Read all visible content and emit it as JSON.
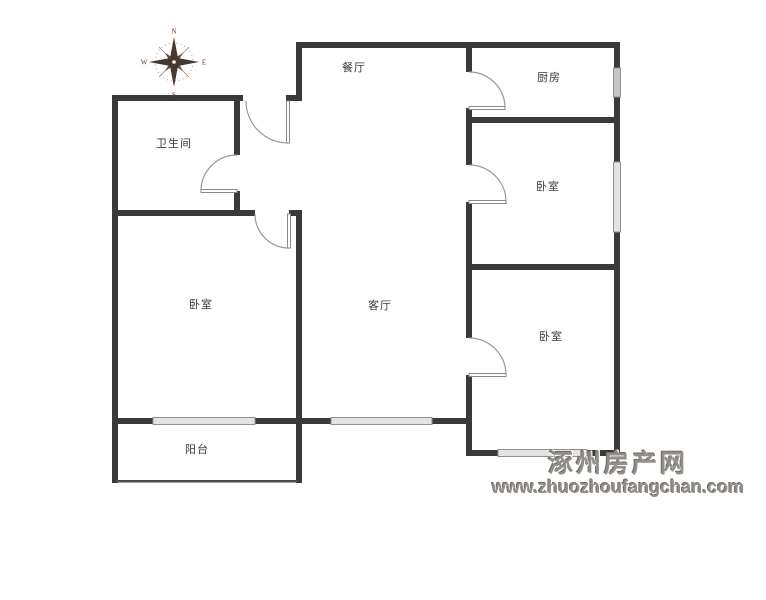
{
  "plan": {
    "rooms": [
      {
        "id": "dining",
        "label": "餐厅"
      },
      {
        "id": "kitchen",
        "label": "厨房"
      },
      {
        "id": "bathroom",
        "label": "卫生间"
      },
      {
        "id": "bedroom-top-right",
        "label": "卧室"
      },
      {
        "id": "bedroom-left",
        "label": "卧室"
      },
      {
        "id": "living",
        "label": "客厅"
      },
      {
        "id": "bedroom-bottom-right",
        "label": "卧室"
      },
      {
        "id": "balcony",
        "label": "阳台"
      }
    ],
    "compass": {
      "north": "N",
      "south": "S",
      "east": "E",
      "west": "W"
    }
  },
  "watermark": {
    "site_name": "涿州房产网",
    "site_url": "www.zhuozhoufangchan.com"
  },
  "colors": {
    "wall": "#3a3a3a",
    "door_arc": "#9a9a9a",
    "window_fill": "#e3e3e3",
    "watermark": "#928e89",
    "compass_letter": "#7e2d1f"
  }
}
